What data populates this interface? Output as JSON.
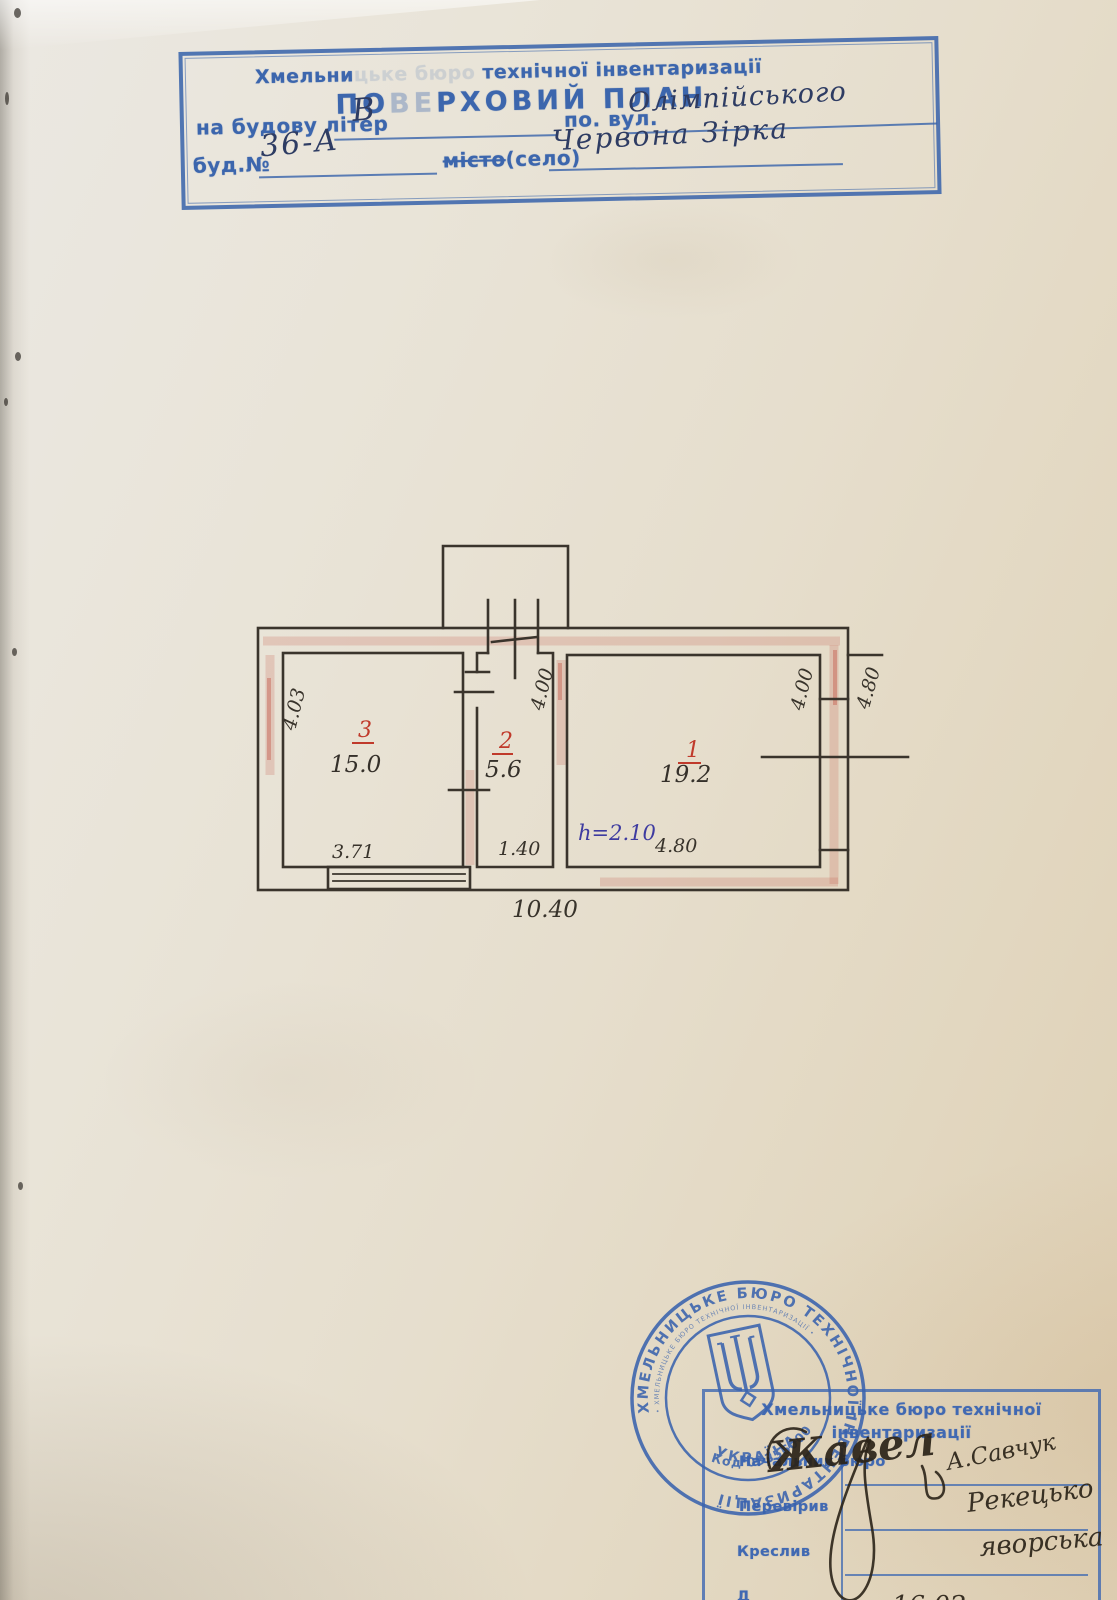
{
  "top_stamp": {
    "org_start": "Хмельни",
    "org_faded": "цьке бюро",
    "org_end": " технічної інвентаризації",
    "title_start": "ПО",
    "title_faded": "ВЕ",
    "title_end": "РХОВИЙ ПЛАН",
    "field_building_label": "на будову літер",
    "field_building_value": "В",
    "field_street_label": "по. вул.",
    "field_street_value": "Олімпійського",
    "field_number_label": "буд.№",
    "field_number_value": "36-А",
    "field_city_label_struck": "місто",
    "field_city_label_rest": "(село)",
    "field_city_value": "Червона Зірка"
  },
  "plan": {
    "room1": {
      "number": "1",
      "area": "19.2",
      "width": "4.80",
      "height": "4.00",
      "height_note": "h=2.10"
    },
    "room2": {
      "number": "2",
      "area": "5.6",
      "width": "1.40",
      "height": "4.00"
    },
    "room3": {
      "number": "3",
      "area": "15.0",
      "width": "3.71",
      "height": "4.03"
    },
    "total_width": "10.40",
    "exterior_height": "4.80"
  },
  "round_stamp": {
    "ring_text": "ХМЕЛЬНИЦЬКЕ БЮРО ТЕХНІЧНОЇ ІНВЕНТАРИЗАЦІЇ",
    "ring_text_small": "• ХМЕЛЬНИЦЬКЕ БЮРО ТЕХНІЧНОЇ ІНВЕНТАРИЗАЦІЇ •",
    "code": "Код 03356000",
    "country": "УКРАЇНА"
  },
  "signature_stamp": {
    "header_line1": "Хмельницьке бюро технічної",
    "header_line2": "інвентаризації",
    "row_chief": "Начальник бюро",
    "row_checked": "Перевірив",
    "row_drawn": "Креслив",
    "row_clipped": "Д"
  },
  "signatures": {
    "sig_chief": "Жавел",
    "sig_chief_note": "А.Савчук",
    "sig_checked": "Рекецько",
    "sig_drawn": "яворська",
    "date_partial": "16.02"
  }
}
